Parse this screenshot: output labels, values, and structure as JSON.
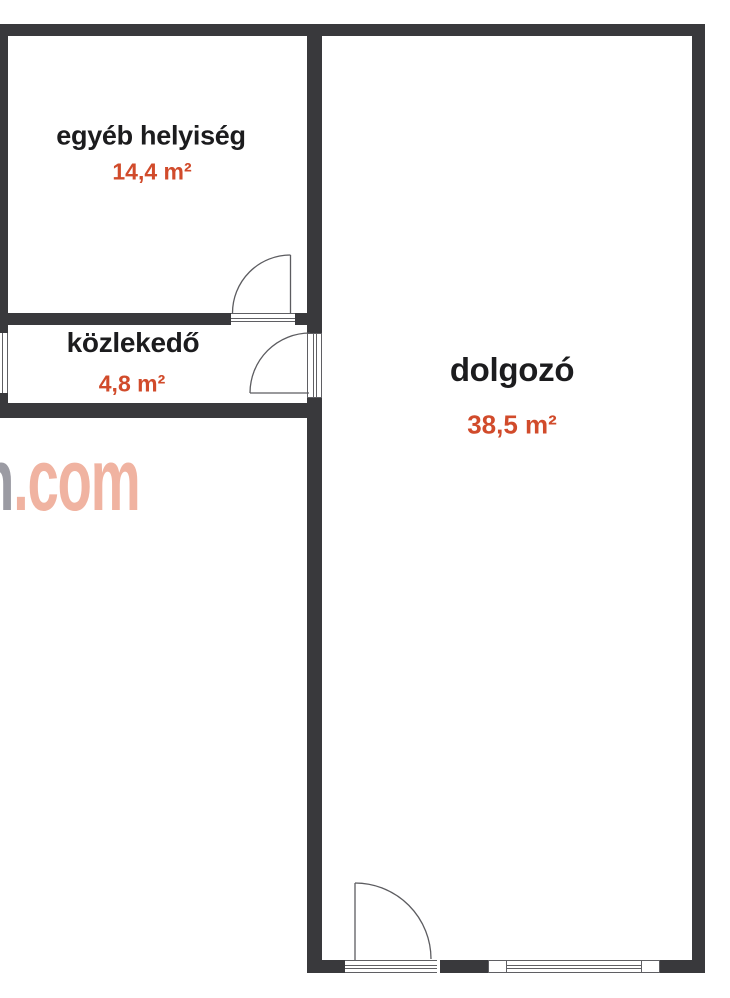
{
  "floorplan": {
    "rooms": [
      {
        "name": "egyéb helyiség",
        "area": "14,4 m²"
      },
      {
        "name": "közlekedő",
        "area": "4,8 m²"
      },
      {
        "name": "dolgozó",
        "area": "38,5 m²"
      }
    ],
    "watermark": {
      "prefix": "n",
      "suffix": ".com"
    },
    "colors": {
      "wall": "#39393c",
      "room_name": "#1c1c1e",
      "room_area": "#d14b2b",
      "watermark_gray": "#9b9ba3",
      "watermark_salmon": "#f0b3a1"
    }
  }
}
